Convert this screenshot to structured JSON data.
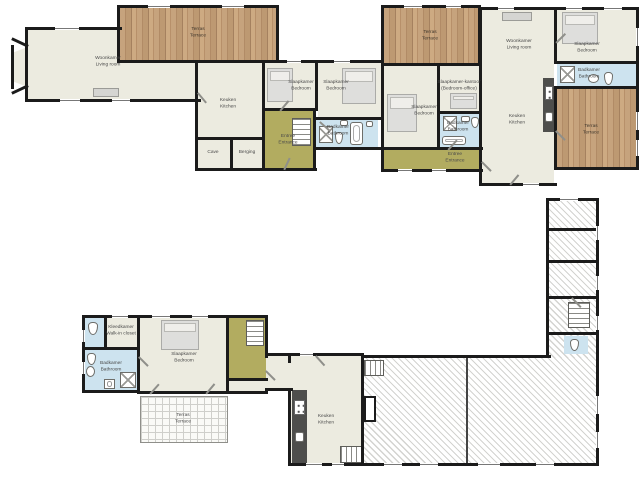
{
  "document": {
    "type": "floor-plan",
    "floors": 2
  },
  "colors": {
    "room_fill": "#ECEBE0",
    "circulation_fill": "#B2AC60",
    "bathroom_fill": "#CDE3EF",
    "terrace_wood": "#C6A37D",
    "wall": "#1B1B1B",
    "counter": "#4E4E4C",
    "label_text": "#4A4A4A"
  },
  "upper_floor": {
    "name": "upper-floor-plan",
    "rooms": [
      {
        "id": "terrace-top-left",
        "label1": "Terras",
        "label2": "Terrace"
      },
      {
        "id": "living-room-left",
        "label1": "Woonkamer",
        "label2": "Living room"
      },
      {
        "id": "kitchen-left",
        "label1": "Keuken",
        "label2": "Kitchen"
      },
      {
        "id": "cellar",
        "label1": "Cave",
        "label2": ""
      },
      {
        "id": "storage",
        "label1": "Berging",
        "label2": ""
      },
      {
        "id": "bedroom-1",
        "label1": "Slaapkamer",
        "label2": "Bedroom"
      },
      {
        "id": "bedroom-2",
        "label1": "Slaapkamer",
        "label2": "Bedroom"
      },
      {
        "id": "entrance-left",
        "label1": "Entree",
        "label2": "Entrance"
      },
      {
        "id": "bathroom-1",
        "label1": "Badkamer",
        "label2": "Bathroom"
      },
      {
        "id": "terrace-top-mid",
        "label1": "Terras",
        "label2": "Terrace"
      },
      {
        "id": "bedroom-office",
        "label1": "Slaapkamer-kantoor",
        "label2": "(Bedroom-office)"
      },
      {
        "id": "bedroom-3",
        "label1": "Slaapkamer",
        "label2": "Bedroom"
      },
      {
        "id": "bathroom-2",
        "label1": "Badkamer",
        "label2": "Bathroom"
      },
      {
        "id": "entrance-right",
        "label1": "Entree",
        "label2": "Entrance"
      },
      {
        "id": "living-room-right",
        "label1": "Woonkamer",
        "label2": "Living room"
      },
      {
        "id": "kitchen-right",
        "label1": "Keuken",
        "label2": "Kitchen"
      },
      {
        "id": "bedroom-4",
        "label1": "Slaapkamer",
        "label2": "Bedroom"
      },
      {
        "id": "bathroom-3",
        "label1": "Badkamer",
        "label2": "Bathroom"
      },
      {
        "id": "terrace-right",
        "label1": "Terras",
        "label2": "Terrace"
      }
    ]
  },
  "lower_floor": {
    "name": "lower-floor-plan",
    "rooms": [
      {
        "id": "walk-in-closet",
        "label1": "Kleedkamer",
        "label2": "Walk-in closet"
      },
      {
        "id": "bathroom-4",
        "label1": "Badkamer",
        "label2": "Bathroom"
      },
      {
        "id": "bedroom-5",
        "label1": "Slaapkamer",
        "label2": "Bedroom"
      },
      {
        "id": "terrace-tiled",
        "label1": "Terras",
        "label2": "Terrace"
      },
      {
        "id": "kitchen-main",
        "label1": "Keuken",
        "label2": "Kitchen"
      }
    ]
  }
}
